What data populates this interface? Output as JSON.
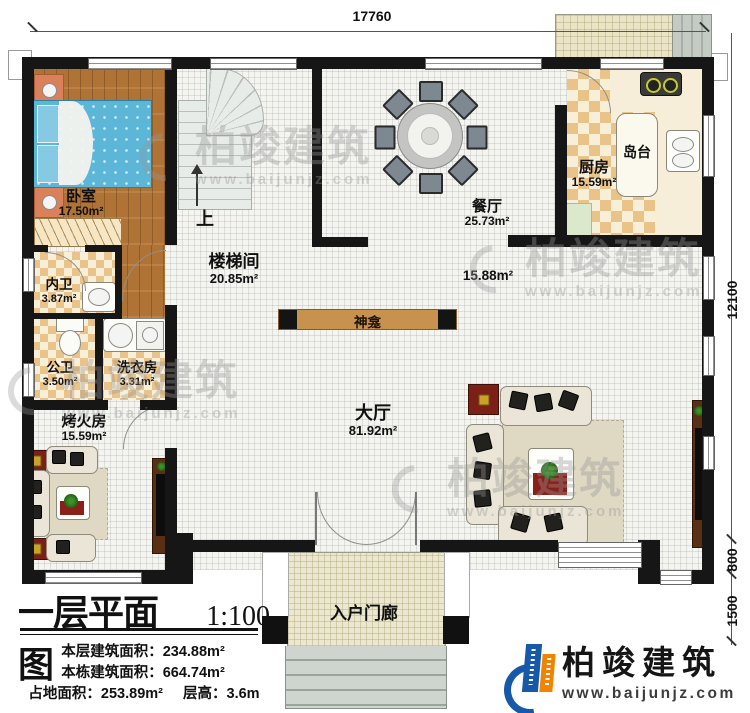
{
  "dims": {
    "top": "17760",
    "right_main": "12100",
    "right_step": "800",
    "right_porch": "1500"
  },
  "plan": {
    "up_label": "上"
  },
  "rooms": {
    "bedroom": {
      "name": "卧室",
      "area": "17.50m²"
    },
    "stairwell": {
      "name": "楼梯间",
      "area": "20.85m²"
    },
    "dining": {
      "name": "餐厅",
      "area": "25.73m²"
    },
    "kitchen": {
      "name": "厨房",
      "area": "15.59m²"
    },
    "island": {
      "name": "岛台"
    },
    "inner_bath": {
      "name": "内卫",
      "area": "3.87m²"
    },
    "public_bath": {
      "name": "公卫",
      "area": "3.50m²"
    },
    "laundry": {
      "name": "洗衣房",
      "area": "3.31m²"
    },
    "fire_room": {
      "name": "烤火房",
      "area": "15.59m²"
    },
    "hall": {
      "name": "大厅",
      "area": "81.92m²"
    },
    "open_area": {
      "area": "15.88m²"
    },
    "shrine": {
      "name": "神龛"
    },
    "porch": {
      "name": "入户门廊"
    }
  },
  "legend": {
    "title": "一层平面图",
    "scale": "1:100",
    "lines": [
      {
        "label": "本层建筑面积：",
        "value": "234.88m²"
      },
      {
        "label": "本栋建筑面积：",
        "value": "664.74m²"
      },
      {
        "label": "占地面积：",
        "value": "253.89m²",
        "label2": "层高：",
        "value2": "3.6m"
      }
    ]
  },
  "brand": {
    "name": "柏竣建筑",
    "url": "www.baijunjz.com"
  },
  "watermark": {
    "name": "柏竣建筑",
    "url": "www.baijunjz.com"
  },
  "colors": {
    "wall": "#161616",
    "wood_floor": "#b07336",
    "tile_dark": "#eac389",
    "tile_light": "#f8efd9",
    "brand_blue": "#1659a8",
    "brand_orange": "#f08300",
    "bed_blue": "#5cb6d8",
    "accent_red": "#7c2017"
  }
}
